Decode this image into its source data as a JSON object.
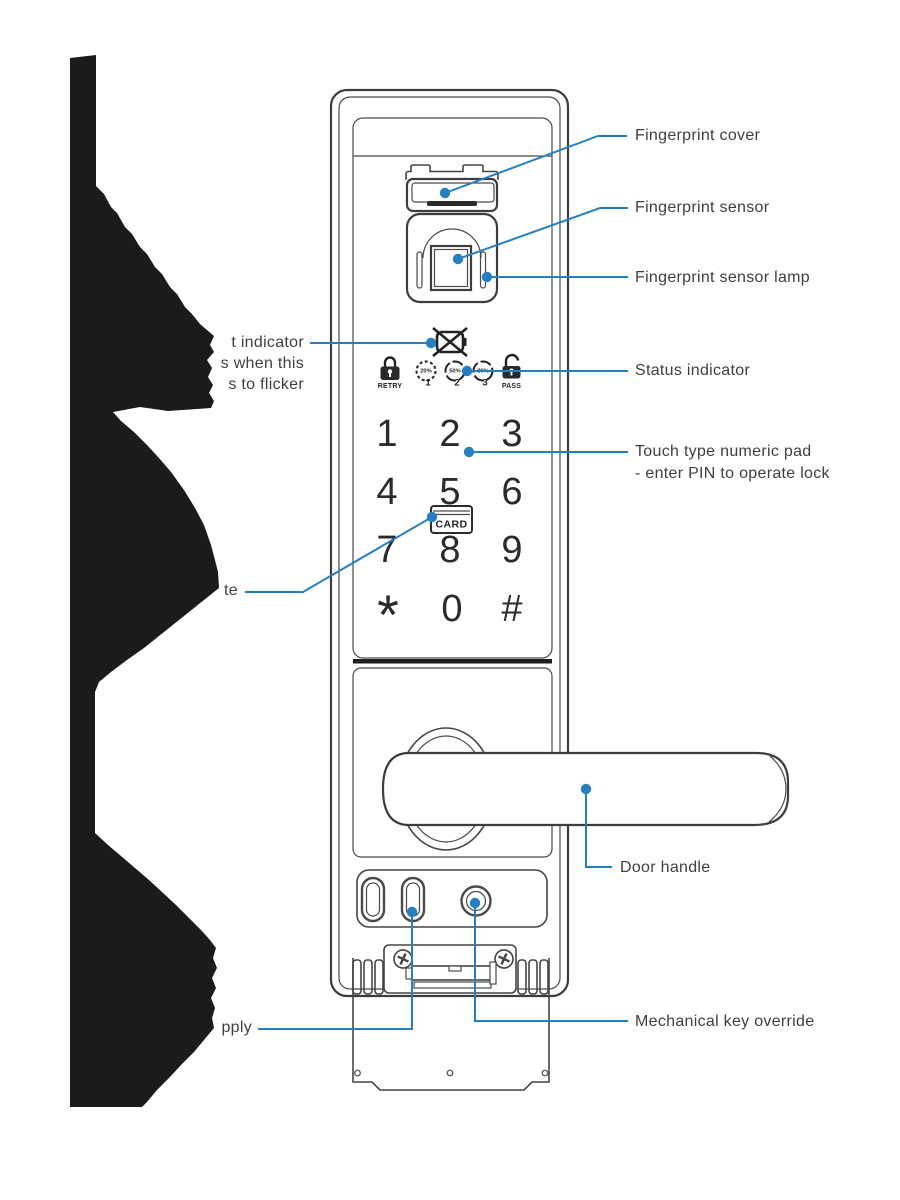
{
  "labels": {
    "fingerprint_cover": "Fingerprint cover",
    "fingerprint_sensor": "Fingerprint sensor",
    "fingerprint_sensor_lamp": "Fingerprint sensor lamp",
    "status_indicator": "Status indicator",
    "numeric_pad_line1": "Touch type numeric pad",
    "numeric_pad_line2": "- enter PIN to operate lock",
    "door_handle": "Door handle",
    "mechanical_key_override": "Mechanical key override",
    "left_obscured_line1": "t indicator",
    "left_obscured_line2": "s when this",
    "left_obscured_line3": "s to flicker",
    "card_obscured": "te",
    "power_obscured": "pply"
  },
  "keypad": {
    "keys": [
      "1",
      "2",
      "3",
      "4",
      "5",
      "6",
      "7",
      "8",
      "9",
      "*",
      "0",
      "#"
    ],
    "card_label": "CARD"
  },
  "status_row": {
    "retry": "RETRY",
    "pass": "PASS",
    "levels": [
      {
        "percent": "20%",
        "step": "1"
      },
      {
        "percent": "50%",
        "step": "2"
      },
      {
        "percent": "80%",
        "step": "3"
      }
    ]
  },
  "icons": {
    "low_battery": "crossed-battery-icon",
    "retry": "locked-padlock-icon",
    "pass": "unlocked-padlock-icon",
    "card": "card-slot-icon",
    "keyhole": "keyhole-icon"
  },
  "colors": {
    "callout_blue": "#2580c3",
    "line_color": "#3f3f3f",
    "blob_black": "#1b1b1b"
  }
}
